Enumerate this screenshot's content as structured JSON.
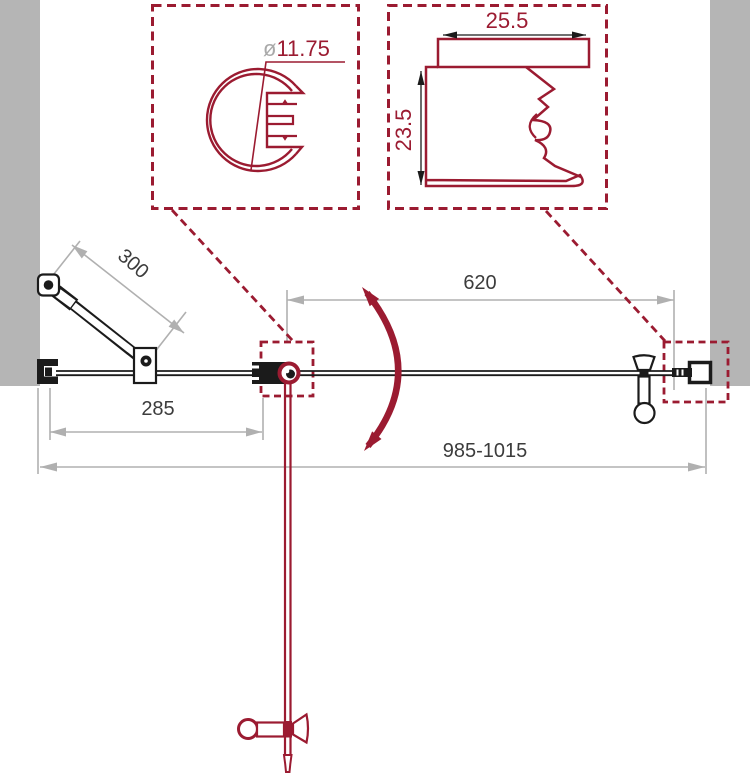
{
  "diagram_labels": {
    "strut_dim": "300",
    "door_width_dim": "620",
    "fixed_panel_dim": "285",
    "total_width_dim": "985-1015"
  },
  "detail_callout_top_profile": {
    "diameter_symbol": "ø",
    "diameter_value": "11.75"
  },
  "detail_callout_wall_profile": {
    "width_dim": "25.5",
    "depth_dim": "23.5"
  },
  "colors": {
    "accent_red": "#9b1b31",
    "wall_gray": "#b5b5b5",
    "dim_line_gray": "#b0b0b0",
    "ink_black": "#1b1b1b",
    "dim_text_dark": "#3c3c3c"
  }
}
